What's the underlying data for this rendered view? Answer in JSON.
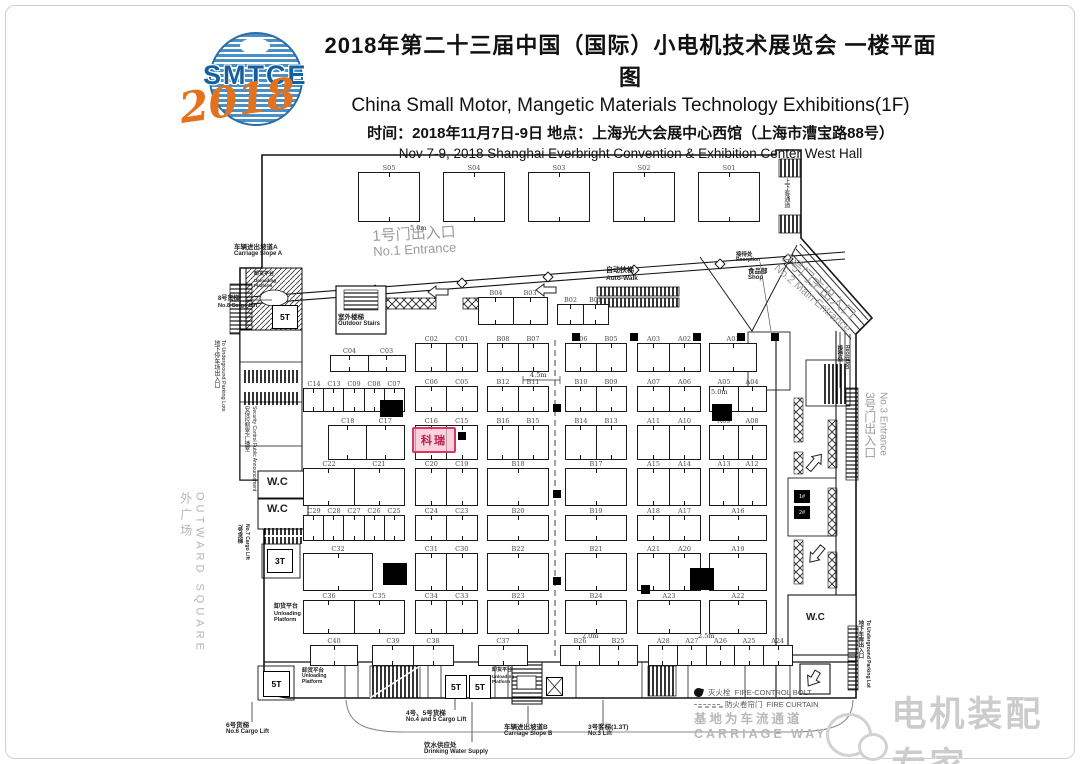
{
  "header": {
    "title_cn": "2018年第二十三届中国（国际）小电机技术展览会  一楼平面图",
    "title_en": "China Small Motor, Mangetic Materials Technology Exhibitions(1F)",
    "info_cn": "时间：2018年11月7日-9日   地点：上海光大会展中心西馆（上海市漕宝路88号）",
    "info_en": "Nov 7-9, 2018 Shanghai Everbright Convention & Exhibition Center West Hall",
    "logo": {
      "name": "SMTCE",
      "year": "2018",
      "blue": "#145f9e",
      "orange": "#e4711c"
    }
  },
  "plan": {
    "s_row": [
      "S05",
      "S04",
      "S03",
      "S02",
      "S01"
    ],
    "booth_groups": [
      {
        "x": 478,
        "y": 297,
        "w": 70,
        "h": 28,
        "cells": [
          "B04",
          "B03"
        ]
      },
      {
        "x": 557,
        "y": 304,
        "w": 52,
        "h": 21,
        "cells": [
          "B02",
          "B01"
        ]
      },
      {
        "x": 330,
        "y": 355,
        "w": 76,
        "h": 17,
        "cells": [
          "C04",
          "C03"
        ]
      },
      {
        "x": 415,
        "y": 343,
        "w": 63,
        "h": 29,
        "cells": [
          "C02",
          "C01"
        ]
      },
      {
        "x": 487,
        "y": 343,
        "w": 62,
        "h": 29,
        "cells": [
          "B08",
          "B07"
        ]
      },
      {
        "x": 565,
        "y": 343,
        "w": 62,
        "h": 29,
        "cells": [
          "B06",
          "B05"
        ]
      },
      {
        "x": 637,
        "y": 343,
        "w": 64,
        "h": 29,
        "cells": [
          "A03",
          "A02"
        ]
      },
      {
        "x": 709,
        "y": 343,
        "w": 48,
        "h": 29,
        "cells": [
          "A01"
        ]
      },
      {
        "x": 303,
        "y": 388,
        "w": 102,
        "h": 24,
        "cells": [
          "C14",
          "C13",
          "C09",
          "C08",
          "C07"
        ]
      },
      {
        "x": 415,
        "y": 386,
        "w": 63,
        "h": 26,
        "cells": [
          "C06",
          "C05"
        ]
      },
      {
        "x": 487,
        "y": 386,
        "w": 62,
        "h": 26,
        "cells": [
          "B12",
          "B11"
        ]
      },
      {
        "x": 565,
        "y": 386,
        "w": 62,
        "h": 26,
        "cells": [
          "B10",
          "B09"
        ]
      },
      {
        "x": 637,
        "y": 386,
        "w": 64,
        "h": 26,
        "cells": [
          "A07",
          "A06"
        ]
      },
      {
        "x": 709,
        "y": 386,
        "w": 58,
        "h": 26,
        "cells": [
          "A05",
          "A04"
        ]
      },
      {
        "x": 328,
        "y": 425,
        "w": 77,
        "h": 35,
        "cells": [
          "C18",
          "C17"
        ]
      },
      {
        "x": 415,
        "y": 425,
        "w": 63,
        "h": 35,
        "cells": [
          "C16",
          "C15"
        ]
      },
      {
        "x": 487,
        "y": 425,
        "w": 62,
        "h": 35,
        "cells": [
          "B16",
          "B15"
        ]
      },
      {
        "x": 565,
        "y": 425,
        "w": 62,
        "h": 35,
        "cells": [
          "B14",
          "B13"
        ]
      },
      {
        "x": 637,
        "y": 425,
        "w": 64,
        "h": 35,
        "cells": [
          "A11",
          "A10"
        ]
      },
      {
        "x": 709,
        "y": 425,
        "w": 58,
        "h": 35,
        "cells": [
          "A09",
          "A08"
        ]
      },
      {
        "x": 303,
        "y": 468,
        "w": 102,
        "h": 38,
        "cells": [
          "C22",
          "C21"
        ]
      },
      {
        "x": 415,
        "y": 468,
        "w": 63,
        "h": 38,
        "cells": [
          "C20",
          "C19"
        ]
      },
      {
        "x": 487,
        "y": 468,
        "w": 62,
        "h": 38,
        "cells": [
          "B18"
        ]
      },
      {
        "x": 565,
        "y": 468,
        "w": 62,
        "h": 38,
        "cells": [
          "B17"
        ]
      },
      {
        "x": 637,
        "y": 468,
        "w": 64,
        "h": 38,
        "cells": [
          "A15",
          "A14"
        ]
      },
      {
        "x": 709,
        "y": 468,
        "w": 58,
        "h": 38,
        "cells": [
          "A13",
          "A12"
        ]
      },
      {
        "x": 303,
        "y": 515,
        "w": 102,
        "h": 26,
        "cells": [
          "C29",
          "C28",
          "C27",
          "C26",
          "C25"
        ]
      },
      {
        "x": 415,
        "y": 515,
        "w": 63,
        "h": 26,
        "cells": [
          "C24",
          "C23"
        ]
      },
      {
        "x": 487,
        "y": 515,
        "w": 62,
        "h": 26,
        "cells": [
          "B20"
        ]
      },
      {
        "x": 565,
        "y": 515,
        "w": 62,
        "h": 26,
        "cells": [
          "B19"
        ]
      },
      {
        "x": 637,
        "y": 515,
        "w": 64,
        "h": 26,
        "cells": [
          "A18",
          "A17"
        ]
      },
      {
        "x": 709,
        "y": 515,
        "w": 58,
        "h": 26,
        "cells": [
          "A16"
        ]
      },
      {
        "x": 303,
        "y": 553,
        "w": 70,
        "h": 38,
        "cells": [
          "C32"
        ]
      },
      {
        "x": 415,
        "y": 553,
        "w": 63,
        "h": 38,
        "cells": [
          "C31",
          "C30"
        ]
      },
      {
        "x": 487,
        "y": 553,
        "w": 62,
        "h": 38,
        "cells": [
          "B22"
        ]
      },
      {
        "x": 565,
        "y": 553,
        "w": 62,
        "h": 38,
        "cells": [
          "B21"
        ]
      },
      {
        "x": 637,
        "y": 553,
        "w": 64,
        "h": 38,
        "cells": [
          "A21",
          "A20"
        ]
      },
      {
        "x": 709,
        "y": 553,
        "w": 58,
        "h": 38,
        "cells": [
          "A19"
        ]
      },
      {
        "x": 303,
        "y": 600,
        "w": 102,
        "h": 34,
        "cells": [
          "C36",
          "C35"
        ]
      },
      {
        "x": 415,
        "y": 600,
        "w": 63,
        "h": 34,
        "cells": [
          "C34",
          "C33"
        ]
      },
      {
        "x": 487,
        "y": 600,
        "w": 62,
        "h": 34,
        "cells": [
          "B23"
        ]
      },
      {
        "x": 565,
        "y": 600,
        "w": 62,
        "h": 34,
        "cells": [
          "B24"
        ]
      },
      {
        "x": 637,
        "y": 600,
        "w": 64,
        "h": 34,
        "cells": [
          "A23"
        ]
      },
      {
        "x": 709,
        "y": 600,
        "w": 58,
        "h": 34,
        "cells": [
          "A22"
        ]
      },
      {
        "x": 310,
        "y": 645,
        "w": 48,
        "h": 21,
        "cells": [
          "C40"
        ]
      },
      {
        "x": 372,
        "y": 645,
        "w": 82,
        "h": 21,
        "cells": [
          "C39",
          "C38"
        ]
      },
      {
        "x": 478,
        "y": 645,
        "w": 50,
        "h": 21,
        "cells": [
          "C37"
        ]
      },
      {
        "x": 560,
        "y": 645,
        "w": 78,
        "h": 21,
        "cells": [
          "B26",
          "B25"
        ]
      },
      {
        "x": 648,
        "y": 645,
        "w": 145,
        "h": 21,
        "cells": [
          "A28",
          "A27",
          "A26",
          "A25",
          "A24"
        ]
      }
    ],
    "highlight": {
      "label": "科瑞",
      "x": 412,
      "y": 427,
      "w": 40,
      "h": 22,
      "color": "#d93663"
    },
    "lifts": [
      {
        "x": 272,
        "y": 305,
        "w": 26,
        "h": 24,
        "t": "5T"
      },
      {
        "x": 267,
        "y": 549,
        "w": 26,
        "h": 24,
        "t": "3T"
      },
      {
        "x": 263,
        "y": 671,
        "w": 27,
        "h": 26,
        "t": "5T"
      },
      {
        "x": 445,
        "y": 675,
        "w": 22,
        "h": 24,
        "t": "5T"
      },
      {
        "x": 469,
        "y": 675,
        "w": 22,
        "h": 24,
        "t": "5T"
      }
    ],
    "mini_lifts": [
      {
        "x": 794,
        "y": 490,
        "w": 16,
        "h": 13,
        "t": "1#"
      },
      {
        "x": 794,
        "y": 506,
        "w": 16,
        "h": 13,
        "t": "2#"
      }
    ],
    "x_lift": {
      "x": 546,
      "y": 677,
      "w": 17,
      "h": 19
    },
    "dims": [
      {
        "t": "5.0m",
        "x": 410,
        "y": 224
      },
      {
        "t": "4.5m",
        "x": 530,
        "y": 371
      },
      {
        "t": "5.0m",
        "x": 711,
        "y": 388
      },
      {
        "t": "2.0m",
        "x": 582,
        "y": 632
      },
      {
        "t": "2.5m",
        "x": 698,
        "y": 632
      }
    ],
    "blobs": [
      [
        380,
        400,
        23,
        17
      ],
      [
        383,
        563,
        24,
        22
      ],
      [
        690,
        568,
        24,
        22
      ],
      [
        712,
        404,
        20,
        17
      ],
      [
        641,
        585,
        9,
        9
      ],
      [
        458,
        432,
        8,
        8
      ]
    ],
    "squares": [
      [
        572,
        333
      ],
      [
        630,
        333
      ],
      [
        693,
        333
      ],
      [
        737,
        333
      ],
      [
        771,
        333
      ],
      [
        553,
        404
      ],
      [
        553,
        490
      ],
      [
        553,
        577
      ]
    ],
    "labels": [
      {
        "id": "no1-entrance",
        "cn": "1号门出入口",
        "en": "No.1 Entrance",
        "x": 372,
        "y": 228,
        "fs": 15,
        "efs": 13,
        "color": "#9b9b9b",
        "rot": -3
      },
      {
        "id": "carriage-slope-a",
        "cn": "车辆进出坡道A",
        "en": "Carriage Slope A",
        "x": 234,
        "y": 244,
        "fs": 6.5,
        "efs": 6,
        "bold": 1
      },
      {
        "id": "unloading-top",
        "cn": "卸货平台",
        "en": "Unloading",
        "en2": "Platform",
        "x": 254,
        "y": 272,
        "fs": 5,
        "efs": 4.5,
        "bold": 1
      },
      {
        "id": "cargo-lift-8",
        "cn": "8号货梯",
        "en": "No.8 Cargo Lift",
        "x": 218,
        "y": 296,
        "fs": 6,
        "efs": 5.5,
        "bold": 1
      },
      {
        "id": "outdoor-stairs",
        "cn": "室外楼梯",
        "en": "Outdoor Stairs",
        "x": 338,
        "y": 314,
        "fs": 6.5,
        "efs": 6,
        "bold": 1
      },
      {
        "id": "auto-walk",
        "cn": "自动扶梯",
        "en": "Auto-Walk",
        "x": 606,
        "y": 267,
        "fs": 7,
        "efs": 6.5,
        "bold": 1
      },
      {
        "id": "reception-top",
        "cn": "接待处",
        "en": "Reception",
        "x": 736,
        "y": 252,
        "fs": 5.5,
        "efs": 5,
        "bold": 1
      },
      {
        "id": "shop",
        "cn": "食品部",
        "en": "Shop",
        "x": 748,
        "y": 268,
        "fs": 6.5,
        "efs": 6,
        "bold": 1
      },
      {
        "id": "no2-main-entrance",
        "cn": "2号门主出入口",
        "en": "No.2 Main Entrance",
        "x": 790,
        "y": 250,
        "fs": 14,
        "efs": 11,
        "color": "#9b9b9b",
        "rot": 41
      },
      {
        "id": "bay-passage",
        "cn": "上下客通道",
        "x": 782,
        "y": 178,
        "fs": 6,
        "vert": 1
      },
      {
        "id": "no3-entrance",
        "cn": "3号门出入口",
        "en": "No.3 Entrance",
        "x": 862,
        "y": 392,
        "fs": 12,
        "efs": 10,
        "color": "#9b9b9b",
        "vert": 1
      },
      {
        "id": "reception-right",
        "cn": "接待处",
        "en": "Reception",
        "x": 836,
        "y": 345,
        "fs": 5.5,
        "efs": 5,
        "vert": 1,
        "bold": 1
      },
      {
        "id": "underground-left",
        "cn": "地下停车场出入口",
        "en": "To Underground Parking Lots",
        "x": 212,
        "y": 340,
        "fs": 6,
        "efs": 5.5,
        "vert": 1
      },
      {
        "id": "security-control",
        "cn": "安保控制室/广播室",
        "en": "Security Control Public Announcement",
        "x": 243,
        "y": 406,
        "fs": 5.5,
        "efs": 5,
        "vert": 1
      },
      {
        "id": "wc-1",
        "cn": "W.C",
        "x": 267,
        "y": 476,
        "fs": 11,
        "bold": 1
      },
      {
        "id": "wc-2",
        "cn": "W.C",
        "x": 267,
        "y": 503,
        "fs": 11,
        "bold": 1
      },
      {
        "id": "wc-right",
        "cn": "W.C",
        "x": 806,
        "y": 612,
        "fs": 10,
        "bold": 1
      },
      {
        "id": "cargo-lift-7",
        "cn": "7号货梯",
        "en": "No.7 Cargo Lift",
        "x": 236,
        "y": 524,
        "fs": 5.5,
        "efs": 5,
        "vert": 1,
        "bold": 1
      },
      {
        "id": "outward-square",
        "cn": "外广场",
        "en": "OUTWARD SQUARE",
        "x": 178,
        "y": 492,
        "fs": 12,
        "efs": 11,
        "color": "#b5b5b5",
        "vert": 1,
        "ls": 4
      },
      {
        "id": "unloading-mid",
        "cn": "卸货平台",
        "en": "Unloading",
        "en2": "Platform",
        "x": 274,
        "y": 604,
        "fs": 6,
        "efs": 5.5,
        "bold": 1
      },
      {
        "id": "unloading-b1",
        "cn": "卸货平台",
        "en": "Unloading",
        "en2": "Platform",
        "x": 302,
        "y": 668,
        "fs": 5.5,
        "efs": 5,
        "bold": 1
      },
      {
        "id": "unloading-b2",
        "cn": "卸货平台",
        "en": "Unloading",
        "en2": "Platform",
        "x": 492,
        "y": 668,
        "fs": 5,
        "efs": 4.5,
        "bold": 1
      },
      {
        "id": "cargo-lift-6",
        "cn": "6号货梯",
        "en": "No.6 Cargo Lift",
        "x": 226,
        "y": 722,
        "fs": 6.5,
        "efs": 6,
        "bold": 1
      },
      {
        "id": "cargo-lift-4-5",
        "cn": "4号、5号货梯",
        "en": "No.4 and 5 Cargo Lift",
        "x": 406,
        "y": 710,
        "fs": 6.5,
        "efs": 6,
        "bold": 1
      },
      {
        "id": "drinking-water",
        "cn": "饮水供应处",
        "en": "Drinking Water Supply",
        "x": 424,
        "y": 742,
        "fs": 6.5,
        "efs": 6,
        "bold": 1
      },
      {
        "id": "carriage-slope-b",
        "cn": "车辆进出坡道B",
        "en": "Carriage Slope B",
        "x": 504,
        "y": 724,
        "fs": 6.5,
        "efs": 6,
        "bold": 1
      },
      {
        "id": "lift-3",
        "cn": "3号客梯(1.3T)",
        "en": "No.3 Lift",
        "x": 588,
        "y": 724,
        "fs": 6.5,
        "efs": 6,
        "bold": 1
      },
      {
        "id": "underground-right",
        "cn": "地下车库出入口",
        "en": "To Underground Parking Lot",
        "x": 857,
        "y": 620,
        "fs": 5.5,
        "efs": 5,
        "vert": 1,
        "bold": 1
      }
    ],
    "legend": {
      "items": [
        {
          "icon": "fire-hydrant-icon",
          "cn": "灭火栓",
          "en": "FIRE-CONTROL BOLT"
        },
        {
          "icon": "fire-curtain-icon",
          "cn": "防火卷帘门",
          "en": "FIRE CURTAIN"
        }
      ],
      "road_cn": "基地为车流通道",
      "road_en": "CARRIAGE WAY"
    },
    "watermark": {
      "icon": "wechat-icon",
      "text": "电机装配专家",
      "color": "#cccccc"
    }
  }
}
